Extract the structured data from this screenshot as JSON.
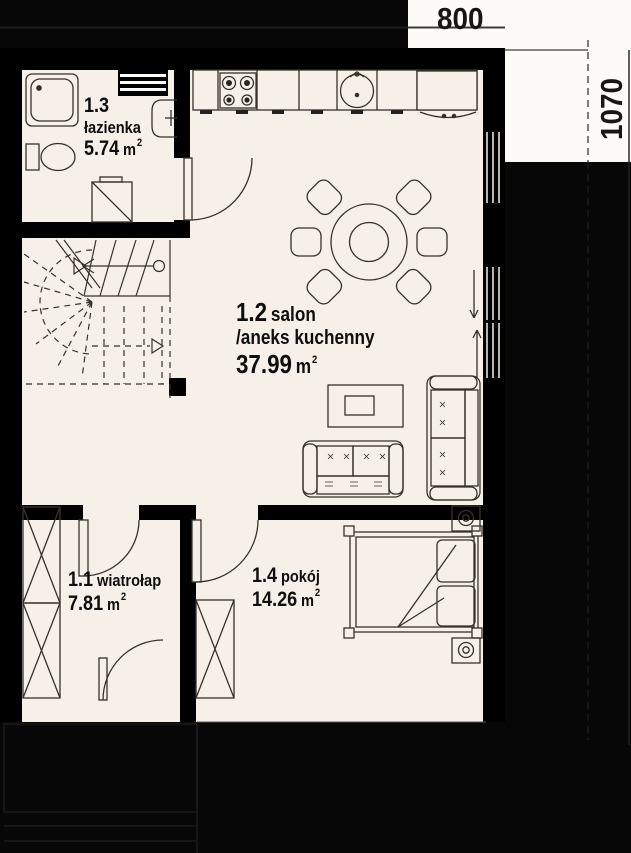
{
  "dimensions": {
    "width_label": "800",
    "height_label": "1070"
  },
  "rooms": {
    "bathroom": {
      "id": "1.3",
      "name": "łazienka",
      "area": "5.74",
      "unit": "m",
      "sup": "2"
    },
    "living": {
      "id": "1.2",
      "name": "salon",
      "name2": "/aneks kuchenny",
      "area": "37.99",
      "unit": "m",
      "sup": "2"
    },
    "vestibule": {
      "id": "1.1",
      "name": "wiatrołap",
      "area": "7.81",
      "unit": "m",
      "sup": "2"
    },
    "room": {
      "id": "1.4",
      "name": "pokój",
      "area": "14.26",
      "unit": "m",
      "sup": "2"
    }
  },
  "colors": {
    "background": "#070707",
    "wall": "#000000",
    "floor": "#f6f0e8",
    "margin_white": "#fcfbf8",
    "furniture_line": "#37312b",
    "text": "#0e0e0e"
  }
}
